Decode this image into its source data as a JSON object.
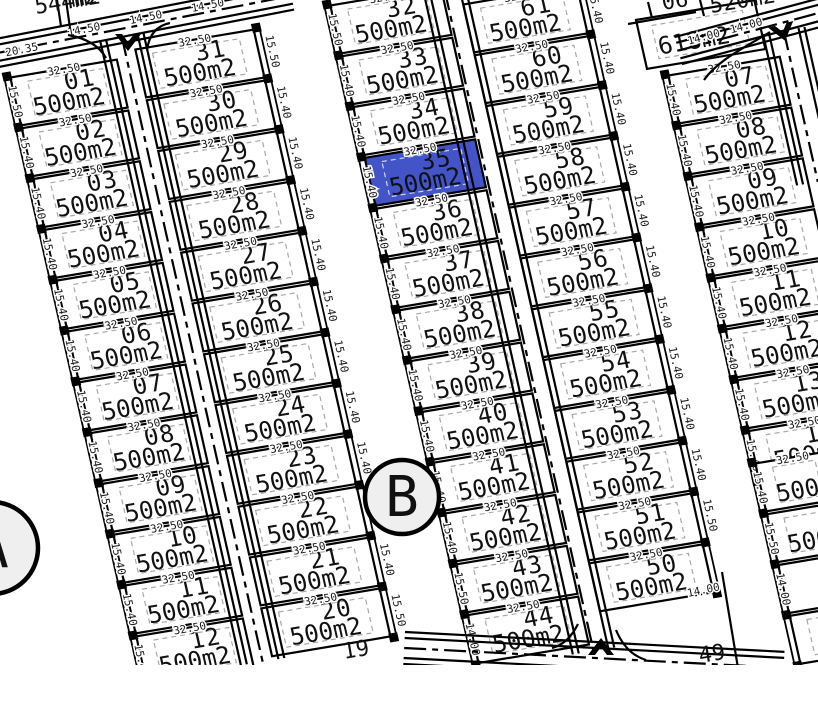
{
  "title": "land-subdivision-plan",
  "colors": {
    "background": "#ffffff",
    "line": "#000000",
    "highlight": "#4254c8",
    "highlight_dash": "#ccd2f0",
    "dash": "#a8a8a8",
    "marker_fill": "#efefef"
  },
  "map_labels": {
    "marker_a": "A",
    "marker_b": "B",
    "dim_width": "32.50",
    "top_road": {
      "dim_left": "20.35",
      "dims": [
        "14.50",
        "14.50",
        "14.50"
      ]
    },
    "top_right_road": {
      "dims": [
        "14.00",
        "14.00"
      ]
    }
  },
  "strips": [
    {
      "id": "strip-1",
      "plots": [
        {
          "n": "01",
          "area": "500m2"
        },
        {
          "n": "02",
          "area": "500m2"
        },
        {
          "n": "03",
          "area": "500m2"
        },
        {
          "n": "04",
          "area": "500m2"
        },
        {
          "n": "05",
          "area": "500m2"
        },
        {
          "n": "06",
          "area": "500m2"
        },
        {
          "n": "07",
          "area": "500m2"
        },
        {
          "n": "08",
          "area": "500m2"
        },
        {
          "n": "09",
          "area": "500m2"
        },
        {
          "n": "10",
          "area": "500m2"
        },
        {
          "n": "11",
          "area": "500m2"
        },
        {
          "n": "12",
          "area": "500m2"
        }
      ],
      "side_dims": [
        "15.50",
        "15.40",
        "15.40",
        "15.40",
        "15.40",
        "15.40",
        "15.40",
        "15.40",
        "15.40",
        "15.40",
        "15.40",
        "15.40"
      ]
    },
    {
      "id": "strip-2",
      "plots": [
        {
          "n": "31",
          "area": "500m2"
        },
        {
          "n": "30",
          "area": "500m2"
        },
        {
          "n": "29",
          "area": "500m2"
        },
        {
          "n": "28",
          "area": "500m2"
        },
        {
          "n": "27",
          "area": "500m2"
        },
        {
          "n": "26",
          "area": "500m2"
        },
        {
          "n": "25",
          "area": "500m2"
        },
        {
          "n": "24",
          "area": "500m2"
        },
        {
          "n": "23",
          "area": "500m2"
        },
        {
          "n": "22",
          "area": "500m2"
        },
        {
          "n": "21",
          "area": "500m2"
        },
        {
          "n": "20",
          "area": "500m2"
        }
      ],
      "side_dims": [
        "15.50",
        "15.40",
        "15.40",
        "15.40",
        "15.40",
        "15.40",
        "15.40",
        "15.40",
        "15.40",
        "15.40",
        "15.40",
        "15.50"
      ]
    },
    {
      "id": "strip-3",
      "plots": [
        {
          "n": "32",
          "area": "500m2"
        },
        {
          "n": "33",
          "area": "500m2"
        },
        {
          "n": "34",
          "area": "500m2"
        },
        {
          "n": "35",
          "area": "500m2",
          "hl": true
        },
        {
          "n": "36",
          "area": "500m2"
        },
        {
          "n": "37",
          "area": "500m2"
        },
        {
          "n": "38",
          "area": "500m2"
        },
        {
          "n": "39",
          "area": "500m2"
        },
        {
          "n": "40",
          "area": "500m2"
        },
        {
          "n": "41",
          "area": "500m2"
        },
        {
          "n": "42",
          "area": "500m2"
        },
        {
          "n": "43",
          "area": "500m2"
        },
        {
          "n": "44",
          "area": "500m2"
        }
      ],
      "side_dims": [
        "15.50",
        "15.40",
        "15.40",
        "15.40",
        "15.40",
        "15.40",
        "15.40",
        "15.40",
        "15.40",
        "15.40",
        "15.40",
        "15.50",
        "14.00"
      ]
    },
    {
      "id": "strip-4",
      "plots": [
        {
          "n": "61",
          "area": "500m2"
        },
        {
          "n": "60",
          "area": "500m2"
        },
        {
          "n": "59",
          "area": "500m2"
        },
        {
          "n": "58",
          "area": "500m2"
        },
        {
          "n": "57",
          "area": "500m2"
        },
        {
          "n": "56",
          "area": "500m2"
        },
        {
          "n": "55",
          "area": "500m2"
        },
        {
          "n": "54",
          "area": "500m2"
        },
        {
          "n": "53",
          "area": "500m2"
        },
        {
          "n": "52",
          "area": "500m2"
        },
        {
          "n": "51",
          "area": "500m2"
        },
        {
          "n": "50",
          "area": "500m2"
        }
      ],
      "side_dims": [
        "15.40",
        "15.40",
        "15.40",
        "15.40",
        "15.40",
        "15.40",
        "15.40",
        "15.40",
        "15.40",
        "15.40",
        "15.50",
        ""
      ]
    },
    {
      "id": "strip-5",
      "plots": [
        {
          "n": "07",
          "area": "500m2"
        },
        {
          "n": "08",
          "area": "500m2"
        },
        {
          "n": "09",
          "area": "500m2"
        },
        {
          "n": "10",
          "area": "500m2"
        },
        {
          "n": "11",
          "area": "500m2"
        },
        {
          "n": "12",
          "area": "500m2"
        },
        {
          "n": "13",
          "area": "500m2"
        },
        {
          "n": "14",
          "area": "500m2"
        }
      ],
      "side_dims": [
        "15.40",
        "15.40",
        "15.40",
        "15.40",
        "15.40",
        "15.40",
        "15.40",
        "15.40"
      ]
    },
    {
      "id": "strip-6",
      "plots": [
        {
          "n": "",
          "area": "500",
          "td": true
        },
        {
          "n": "",
          "area": "500",
          "td": false
        },
        {
          "n": "",
          "area": "",
          "td": false
        },
        {
          "n": "55",
          "area": "",
          "td": false
        }
      ],
      "side_dims": [
        "15.40",
        "15.50",
        "14.00",
        ""
      ]
    }
  ],
  "special_plots": {
    "plot_618": {
      "area": "618m2"
    }
  },
  "fragments": [
    {
      "id": "plot-544",
      "text": "544m2"
    },
    {
      "id": "top-partial-m2",
      "text": "m2"
    },
    {
      "id": "plot-06",
      "text": "06"
    },
    {
      "id": "plot-520",
      "text": "520m2"
    },
    {
      "id": "plot-19",
      "text": "19"
    },
    {
      "id": "plot-49",
      "text": "49"
    },
    {
      "id": "dim-50-bottom",
      "text": "14.00"
    }
  ]
}
